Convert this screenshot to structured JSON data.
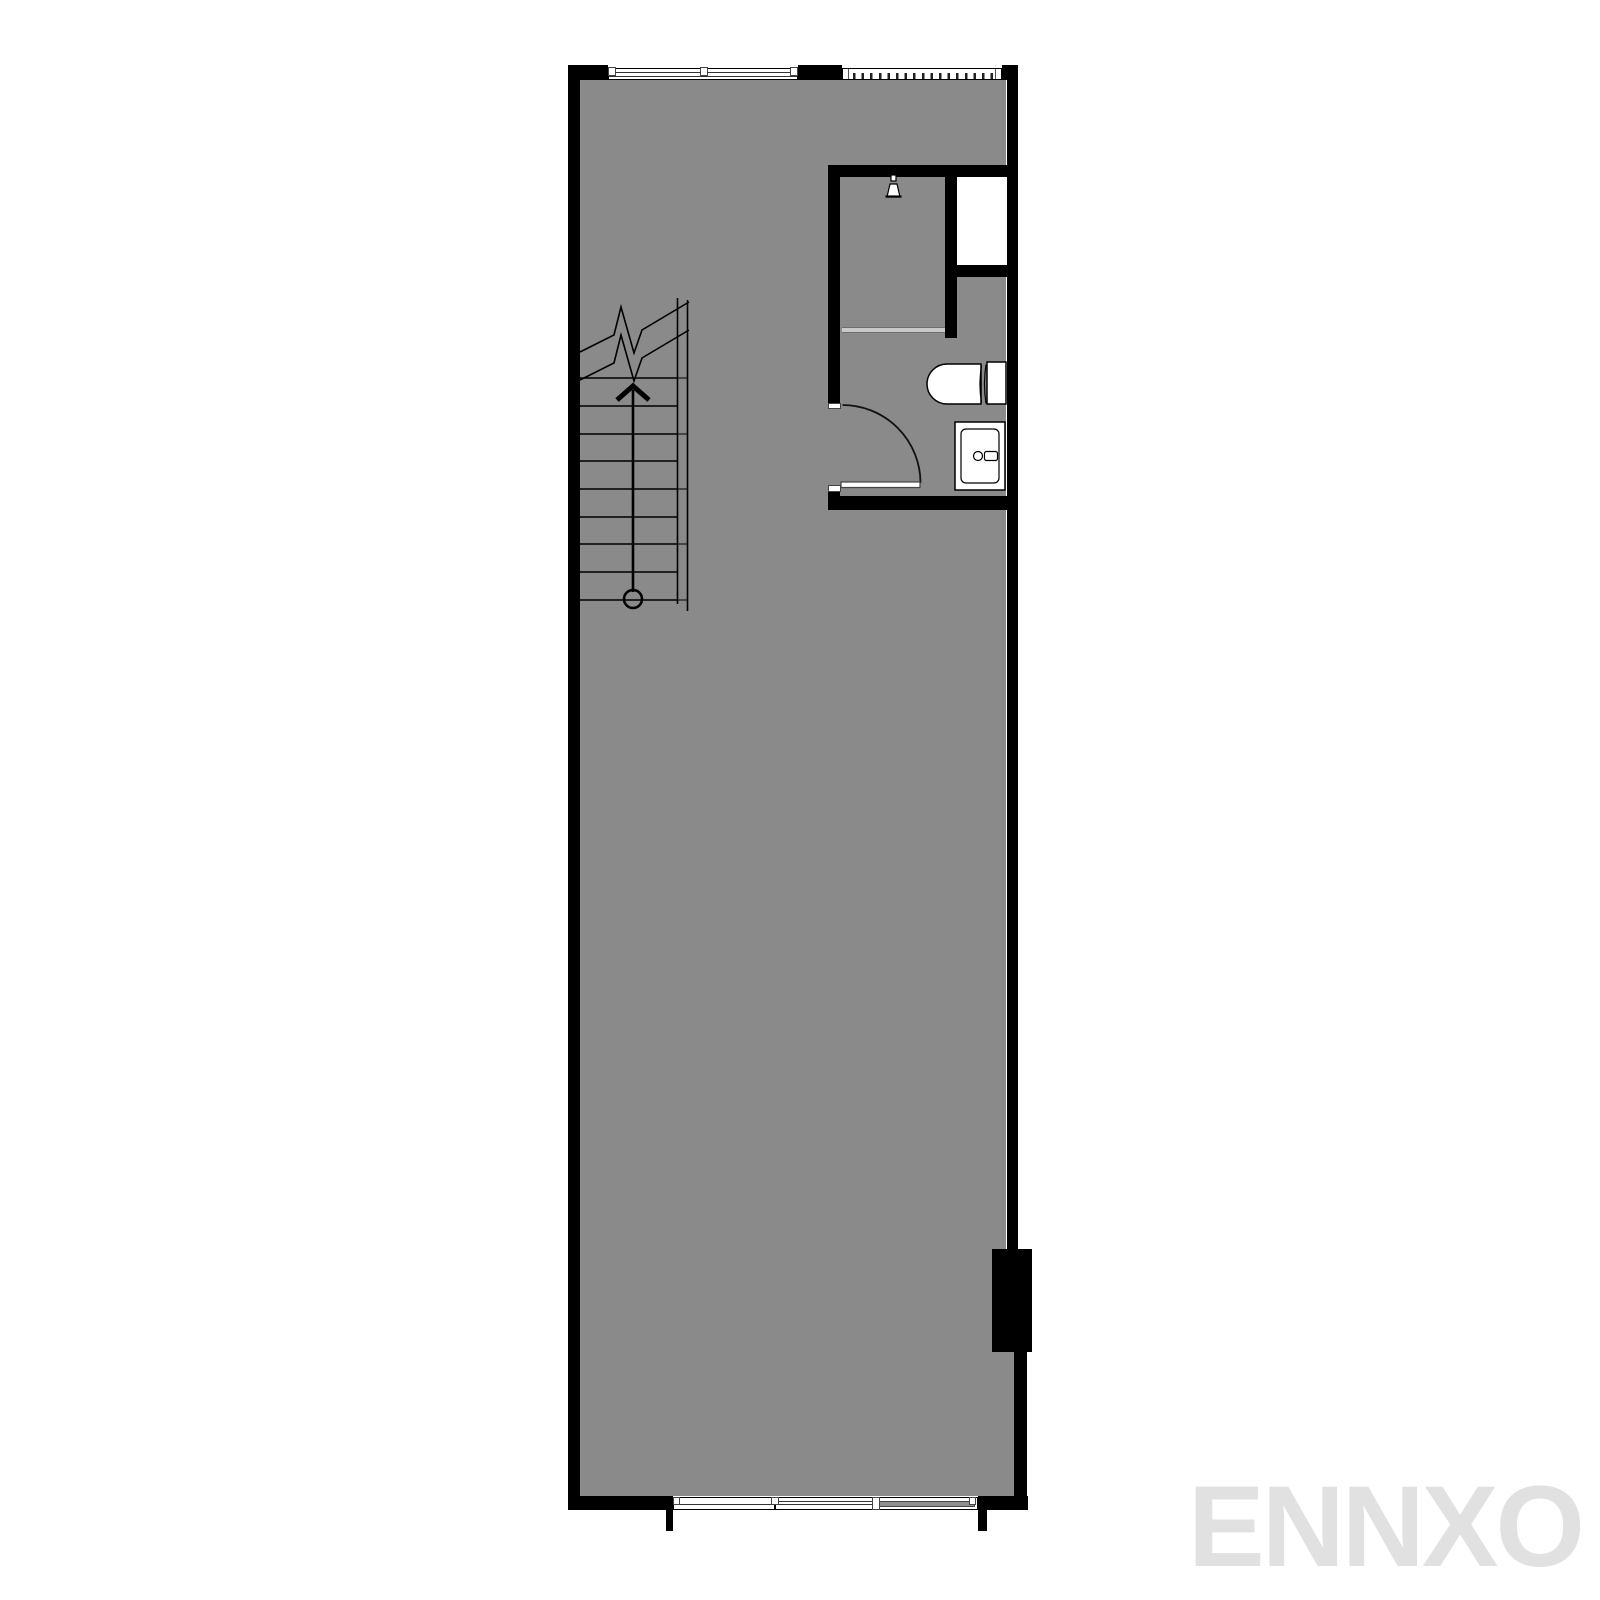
{
  "watermark": {
    "text": "ENNXO"
  },
  "plan": {
    "type": "architectural-floor-plan",
    "colors": {
      "background": "#ffffff",
      "floor": "#8a8a8a",
      "wall": "#000000",
      "glass_partition": "#c9c9c9",
      "window_panel": "#8f8f8f",
      "watermark": "#e1e1e1"
    },
    "icons": [
      "stairs-icon",
      "stair-direction-arrow-icon",
      "break-line-icon",
      "door-swing-icon",
      "shower-head-icon",
      "toilet-icon",
      "sink-icon"
    ],
    "window_groups": {
      "top_casement_panels": 2,
      "top_louver_ticks": 17,
      "bottom_panels": 3
    },
    "stairs": {
      "tread_lines": 9,
      "direction": "up"
    }
  }
}
